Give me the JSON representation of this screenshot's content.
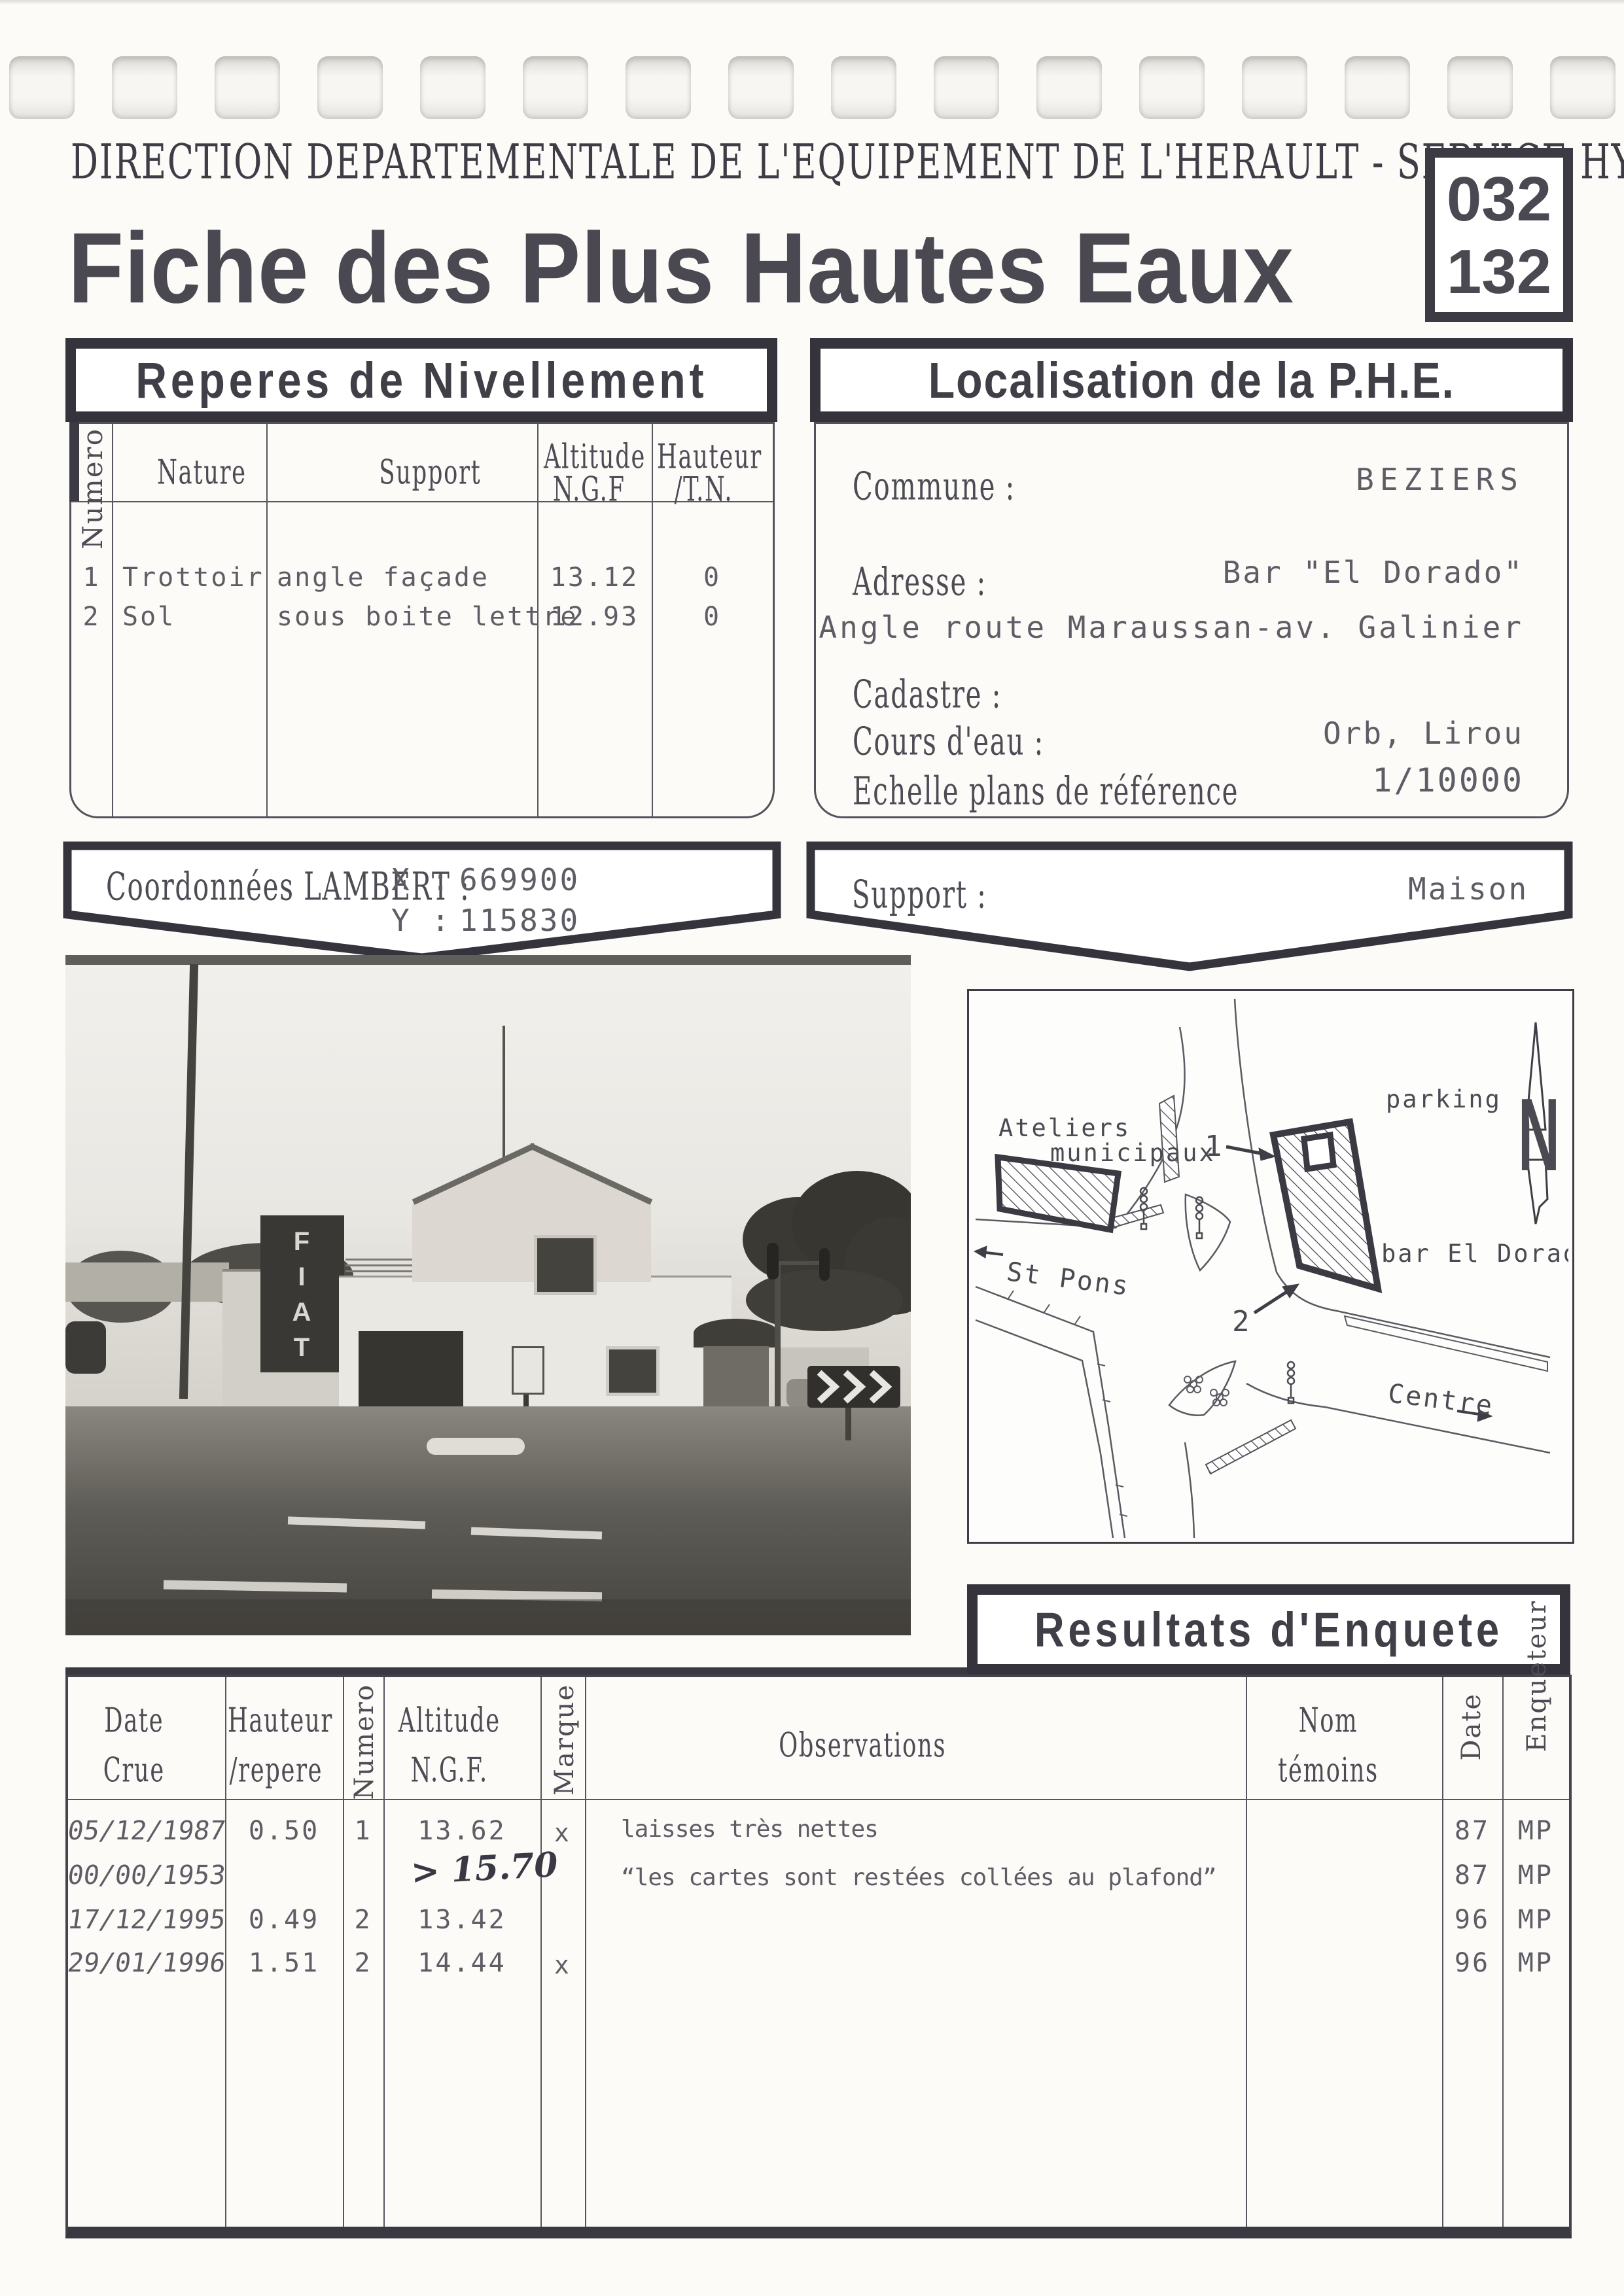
{
  "colors": {
    "ink": "#3c3b43",
    "paper": "#fcfbf8"
  },
  "header": {
    "agency": "DIRECTION DEPARTEMENTALE DE L'EQUIPEMENT DE L'HERAULT - SERVICE HYDRAULIQUE",
    "doc_number_top": "032",
    "doc_number_bottom": "132",
    "title": "Fiche des Plus Hautes Eaux"
  },
  "reperes": {
    "title": "Reperes de Nivellement",
    "col_numero": "Numero",
    "col_nature": "Nature",
    "col_support": "Support",
    "col_altitude_1": "Altitude",
    "col_altitude_2": "N.G.F",
    "col_hauteur_1": "Hauteur",
    "col_hauteur_2": "/T.N.",
    "rows": [
      {
        "numero": "1",
        "nature": "Trottoir",
        "support": "angle façade",
        "altitude": "13.12",
        "hauteur": "0"
      },
      {
        "numero": "2",
        "nature": "Sol",
        "support": "sous boite lettre",
        "altitude": "12.93",
        "hauteur": "0"
      }
    ]
  },
  "localisation": {
    "title": "Localisation de la P.H.E.",
    "commune_label": "Commune :",
    "commune": "BEZIERS",
    "adresse_label": "Adresse :",
    "adresse_1": "Bar \"El Dorado\"",
    "adresse_2": "Angle route Maraussan-av. Galinier",
    "cadastre_label": "Cadastre :",
    "cours_label": "Cours d'eau :",
    "cours": "Orb, Lirou",
    "echelle_label": "Echelle plans de référence",
    "echelle": "1/10000"
  },
  "coordonnees": {
    "label": "Coordonnées LAMBERT :",
    "x_label": "X :",
    "x": "669900",
    "y_label": "Y :",
    "y": "115830"
  },
  "support_banner": {
    "label": "Support :",
    "value": "Maison"
  },
  "photo": {
    "billboard_text": "FIAT"
  },
  "map": {
    "ateliers_1": "Ateliers",
    "ateliers_2": "municipaux",
    "parking": "parking",
    "bar": "bar El Dorado",
    "st_pons": "St Pons",
    "centre": "Centre",
    "marker_1": "1",
    "marker_2": "2",
    "north": "N"
  },
  "resultats": {
    "title": "Resultats d'Enquete",
    "col_date_1": "Date",
    "col_date_2": "Crue",
    "col_hauteur_1": "Hauteur",
    "col_hauteur_2": "/repere",
    "col_numero": "Numero",
    "col_altitude_1": "Altitude",
    "col_altitude_2": "N.G.F.",
    "col_marque": "Marque",
    "col_observations": "Observations",
    "col_nom_1": "Nom",
    "col_nom_2": "témoins",
    "col_date": "Date",
    "col_enqueteur": "Enqueteur",
    "rows": [
      {
        "date": "05/12/1987",
        "hauteur": "0.50",
        "numero": "1",
        "altitude": "13.62",
        "altitude_hand": "",
        "marque": "x",
        "observations": "laisses très nettes",
        "nom": "",
        "date2": "87",
        "enqueteur": "MP"
      },
      {
        "date": "00/00/1953",
        "hauteur": "",
        "numero": "",
        "altitude": "",
        "altitude_hand": "> 15.70",
        "marque": "",
        "observations": "“les cartes sont restées collées au plafond”",
        "nom": "",
        "date2": "87",
        "enqueteur": "MP"
      },
      {
        "date": "17/12/1995",
        "hauteur": "0.49",
        "numero": "2",
        "altitude": "13.42",
        "altitude_hand": "",
        "marque": "",
        "observations": "",
        "nom": "",
        "date2": "96",
        "enqueteur": "MP"
      },
      {
        "date": "29/01/1996",
        "hauteur": "1.51",
        "numero": "2",
        "altitude": "14.44",
        "altitude_hand": "",
        "marque": "x",
        "observations": "",
        "nom": "",
        "date2": "96",
        "enqueteur": "MP"
      }
    ]
  }
}
